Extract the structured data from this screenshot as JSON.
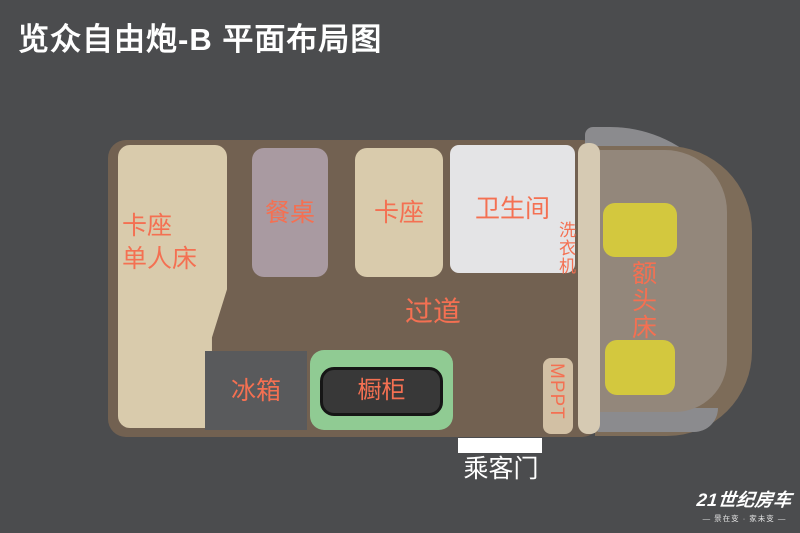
{
  "title": "览众自由炮-B 平面布局图",
  "colors": {
    "background": "#4b4c4e",
    "floor": "#726151",
    "booth_beige": "#d9cbac",
    "table_mauve": "#a99aa1",
    "bathroom_white": "#e4e4e6",
    "fridge_gray": "#595a5c",
    "cabinet_green": "#90cb93",
    "cabinet_dark": "#383838",
    "mppt_beige": "#d2c0a4",
    "partition_beige": "#d6cab3",
    "cab_gray": "#8b8b8e",
    "cab_brown": "#7d6c59",
    "cab_tan": "#93877b",
    "seat_yellow": "#d3c83e",
    "label_orange": "#f47052",
    "door_white": "#ffffff"
  },
  "zones": {
    "dinette_bed": {
      "line1": "卡座",
      "line2": "单人床"
    },
    "dining_table": {
      "label": "餐桌"
    },
    "dinette": {
      "label": "卡座"
    },
    "bathroom": {
      "label": "卫生间"
    },
    "washer": {
      "label": "洗衣机"
    },
    "aisle": {
      "label": "过道"
    },
    "fridge": {
      "label": "冰箱"
    },
    "cabinet": {
      "label": "橱柜"
    },
    "mppt": {
      "label": "MPPT"
    },
    "overhead_bed": {
      "label": "额头床"
    },
    "passenger_door": {
      "label": "乘客门"
    }
  },
  "logo": {
    "brand": "21世纪房车",
    "tagline": "— 景在变 · 家未变 —"
  }
}
